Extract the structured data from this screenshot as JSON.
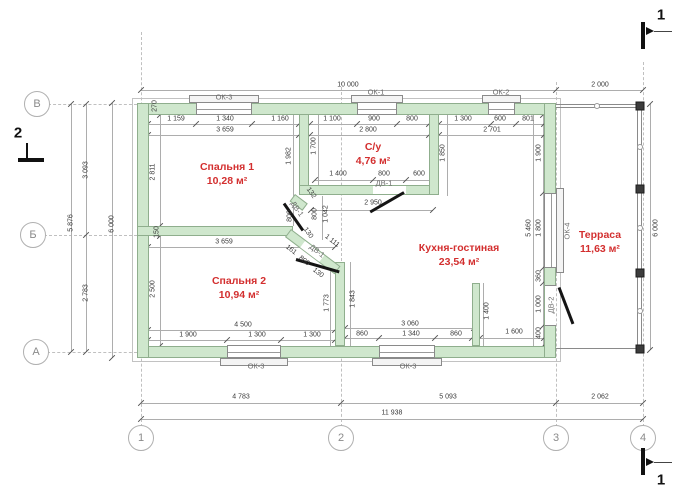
{
  "axes": {
    "rows": [
      "В",
      "Б",
      "А"
    ],
    "cols": [
      "1",
      "2",
      "3",
      "4"
    ]
  },
  "sections": {
    "s1": "1",
    "s2": "2"
  },
  "rooms": [
    {
      "name": "Спальня 1",
      "area": "10,28 м²"
    },
    {
      "name": "С/у",
      "area": "4,76 м²"
    },
    {
      "name": "Спальня 2",
      "area": "10,94 м²"
    },
    {
      "name": "Кухня-гостиная",
      "area": "23,54 м²"
    },
    {
      "name": "Терраса",
      "area": "11,63 м²"
    }
  ],
  "openings": {
    "ok1": "ОК-1",
    "ok2": "ОК-2",
    "ok3": "ОК-3",
    "ok4": "ОК-4",
    "dv1": "ДВ-1",
    "dv2": "ДВ-2"
  },
  "dims": {
    "top": [
      "10 000",
      "2 000"
    ],
    "row1": [
      "1 159",
      "1 340",
      "1 160",
      "1 100",
      "900",
      "800",
      "1 300",
      "600",
      "801"
    ],
    "row2": [
      "3 659",
      "2 800",
      "2 701"
    ],
    "wall": [
      "270",
      "150"
    ],
    "left_inner": [
      "2 811",
      "2 500"
    ],
    "su_vert": [
      "1 700",
      "1 982",
      "1 850"
    ],
    "su_bottom": [
      "1 400",
      "800",
      "600"
    ],
    "corridor": [
      "2 950",
      "1 042",
      "800",
      "800",
      "132",
      "130",
      "1 111",
      "161",
      "800",
      "130"
    ],
    "bed2": [
      "3 659",
      "4 500",
      "1 900",
      "1 300",
      "1 300",
      "1 773",
      "1 843"
    ],
    "kitchen_vert": [
      "1 900",
      "5 460",
      "1 800",
      "360",
      "1 000",
      "400",
      "1 400"
    ],
    "kitchen_bottom": [
      "3 060",
      "860",
      "1 340",
      "860",
      "1 600"
    ],
    "bottom": [
      "4 783",
      "5 093",
      "2 062",
      "11 938"
    ],
    "left_outer": [
      "3 093",
      "2 783",
      "5 876",
      "6 000"
    ],
    "right_outer": [
      "6 000"
    ]
  },
  "colors": {
    "wall_fill": "#cfe7cd",
    "room_label": "#d32f2f",
    "dim_text": "#3a3a3a"
  }
}
